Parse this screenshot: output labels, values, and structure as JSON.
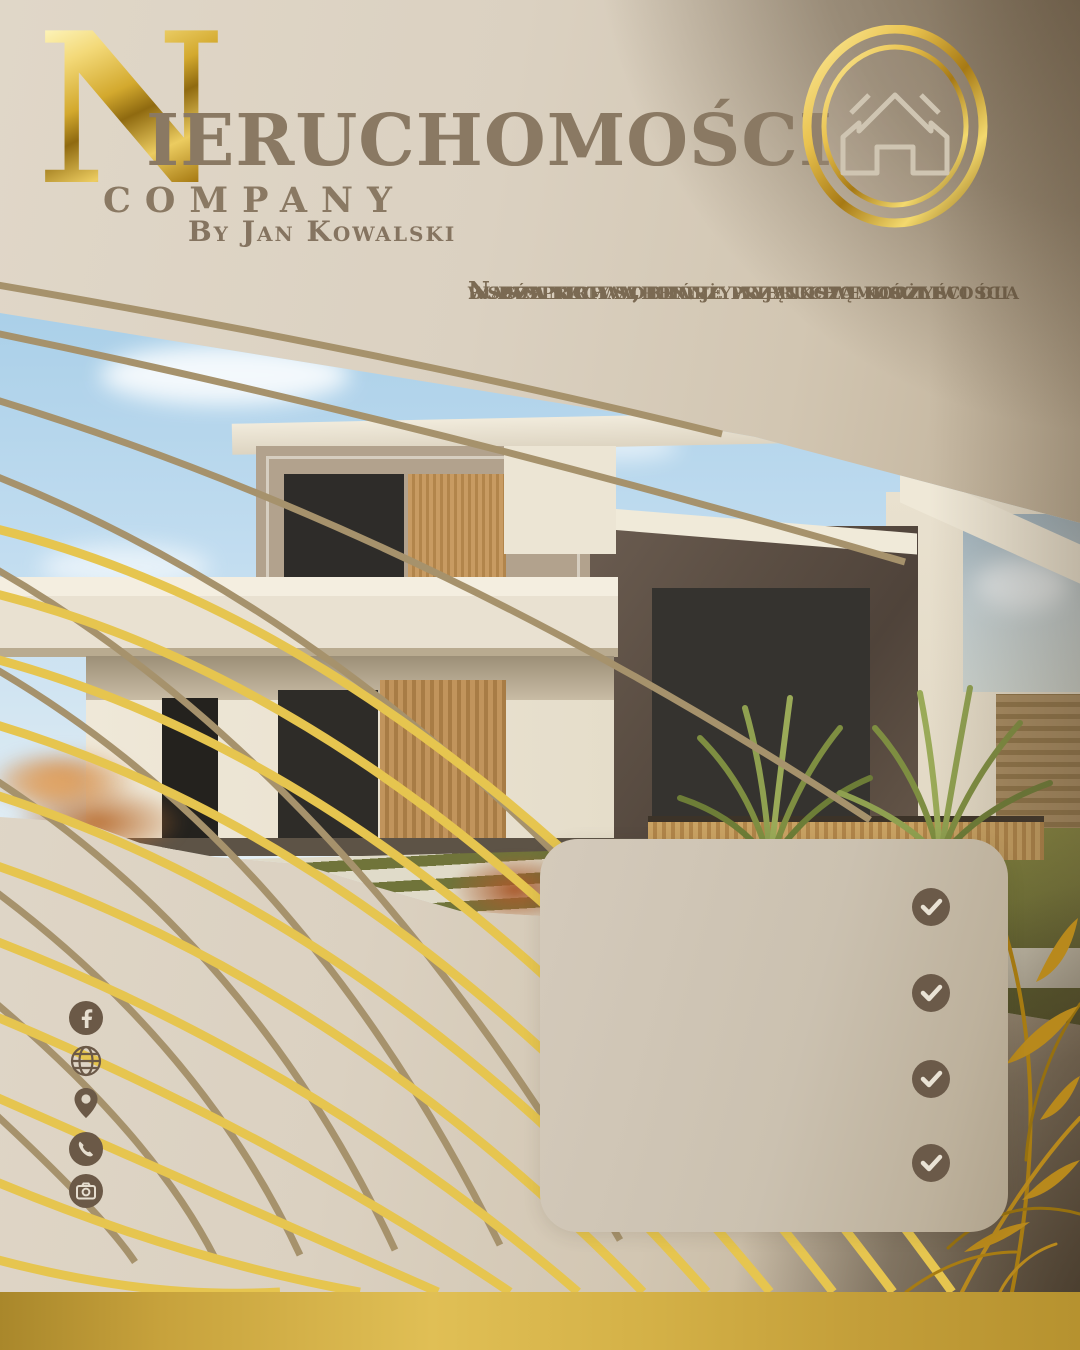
{
  "brand": {
    "initial": "N",
    "name_rest": "IERUCHOMOŚCI",
    "subtitle": "COMPANY",
    "byline": "By Jan Kowalski"
  },
  "badge": {
    "icon": "house-icon"
  },
  "intro": {
    "lines": [
      "Nasza firma oferuje wyjątkowe możliwości",
      "współpracy w branży nieruchomości i",
      "budownictwa, które przynoszą korzyści dla",
      "wszystkich stron."
    ]
  },
  "checklist": {
    "items": [
      {
        "icon": "check-icon"
      },
      {
        "icon": "check-icon"
      },
      {
        "icon": "check-icon"
      },
      {
        "icon": "check-icon"
      }
    ]
  },
  "social": {
    "items": [
      {
        "icon": "facebook-icon"
      },
      {
        "icon": "globe-icon"
      },
      {
        "icon": "location-pin-icon"
      },
      {
        "icon": "phone-icon"
      },
      {
        "icon": "camera-icon"
      }
    ]
  },
  "colors": {
    "background_beige": "#ddd3c3",
    "background_dark_corner": "#544430",
    "title_brown": "#8a7963",
    "body_text_brown": "#7b6a53",
    "gold_bright_line": "#e6c54f",
    "khaki_line": "#a6926c",
    "icon_brown": "#6b5947",
    "card_beige": "#cbc1b0",
    "check_circle_brown": "#6b5a49",
    "gold_bar_light": "#e0bf55",
    "gold_bar_dark": "#a9872b",
    "gold_metal_light": "#f3d978",
    "gold_metal_dark": "#8f6a10"
  }
}
